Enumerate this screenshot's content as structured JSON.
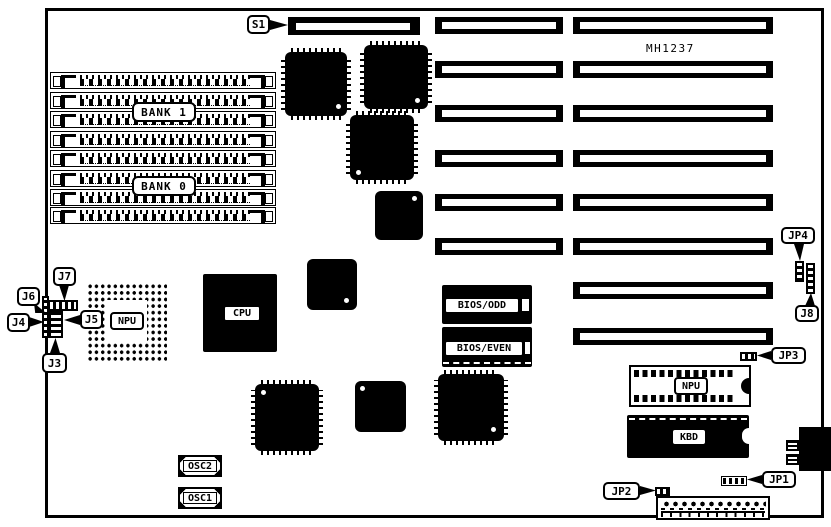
{
  "diagram": {
    "part_number": "MH1237",
    "chips": {
      "bank1": "BANK 1",
      "bank0": "BANK 0",
      "cpu": "CPU",
      "npu_pga": "NPU",
      "npu_dip": "NPU",
      "kbd": "KBD",
      "bios_odd": "BIOS/ODD",
      "bios_even": "BIOS/EVEN",
      "osc2": "OSC2",
      "osc1": "OSC1"
    },
    "callouts": {
      "s1": "S1",
      "j7": "J7",
      "j6": "J6",
      "j4": "J4",
      "j5": "J5",
      "j3": "J3",
      "jp4": "JP4",
      "j8": "J8",
      "jp3": "JP3",
      "jp1": "JP1",
      "jp2": "JP2"
    },
    "colors": {
      "ink": "#000000",
      "paper": "#ffffff"
    }
  }
}
